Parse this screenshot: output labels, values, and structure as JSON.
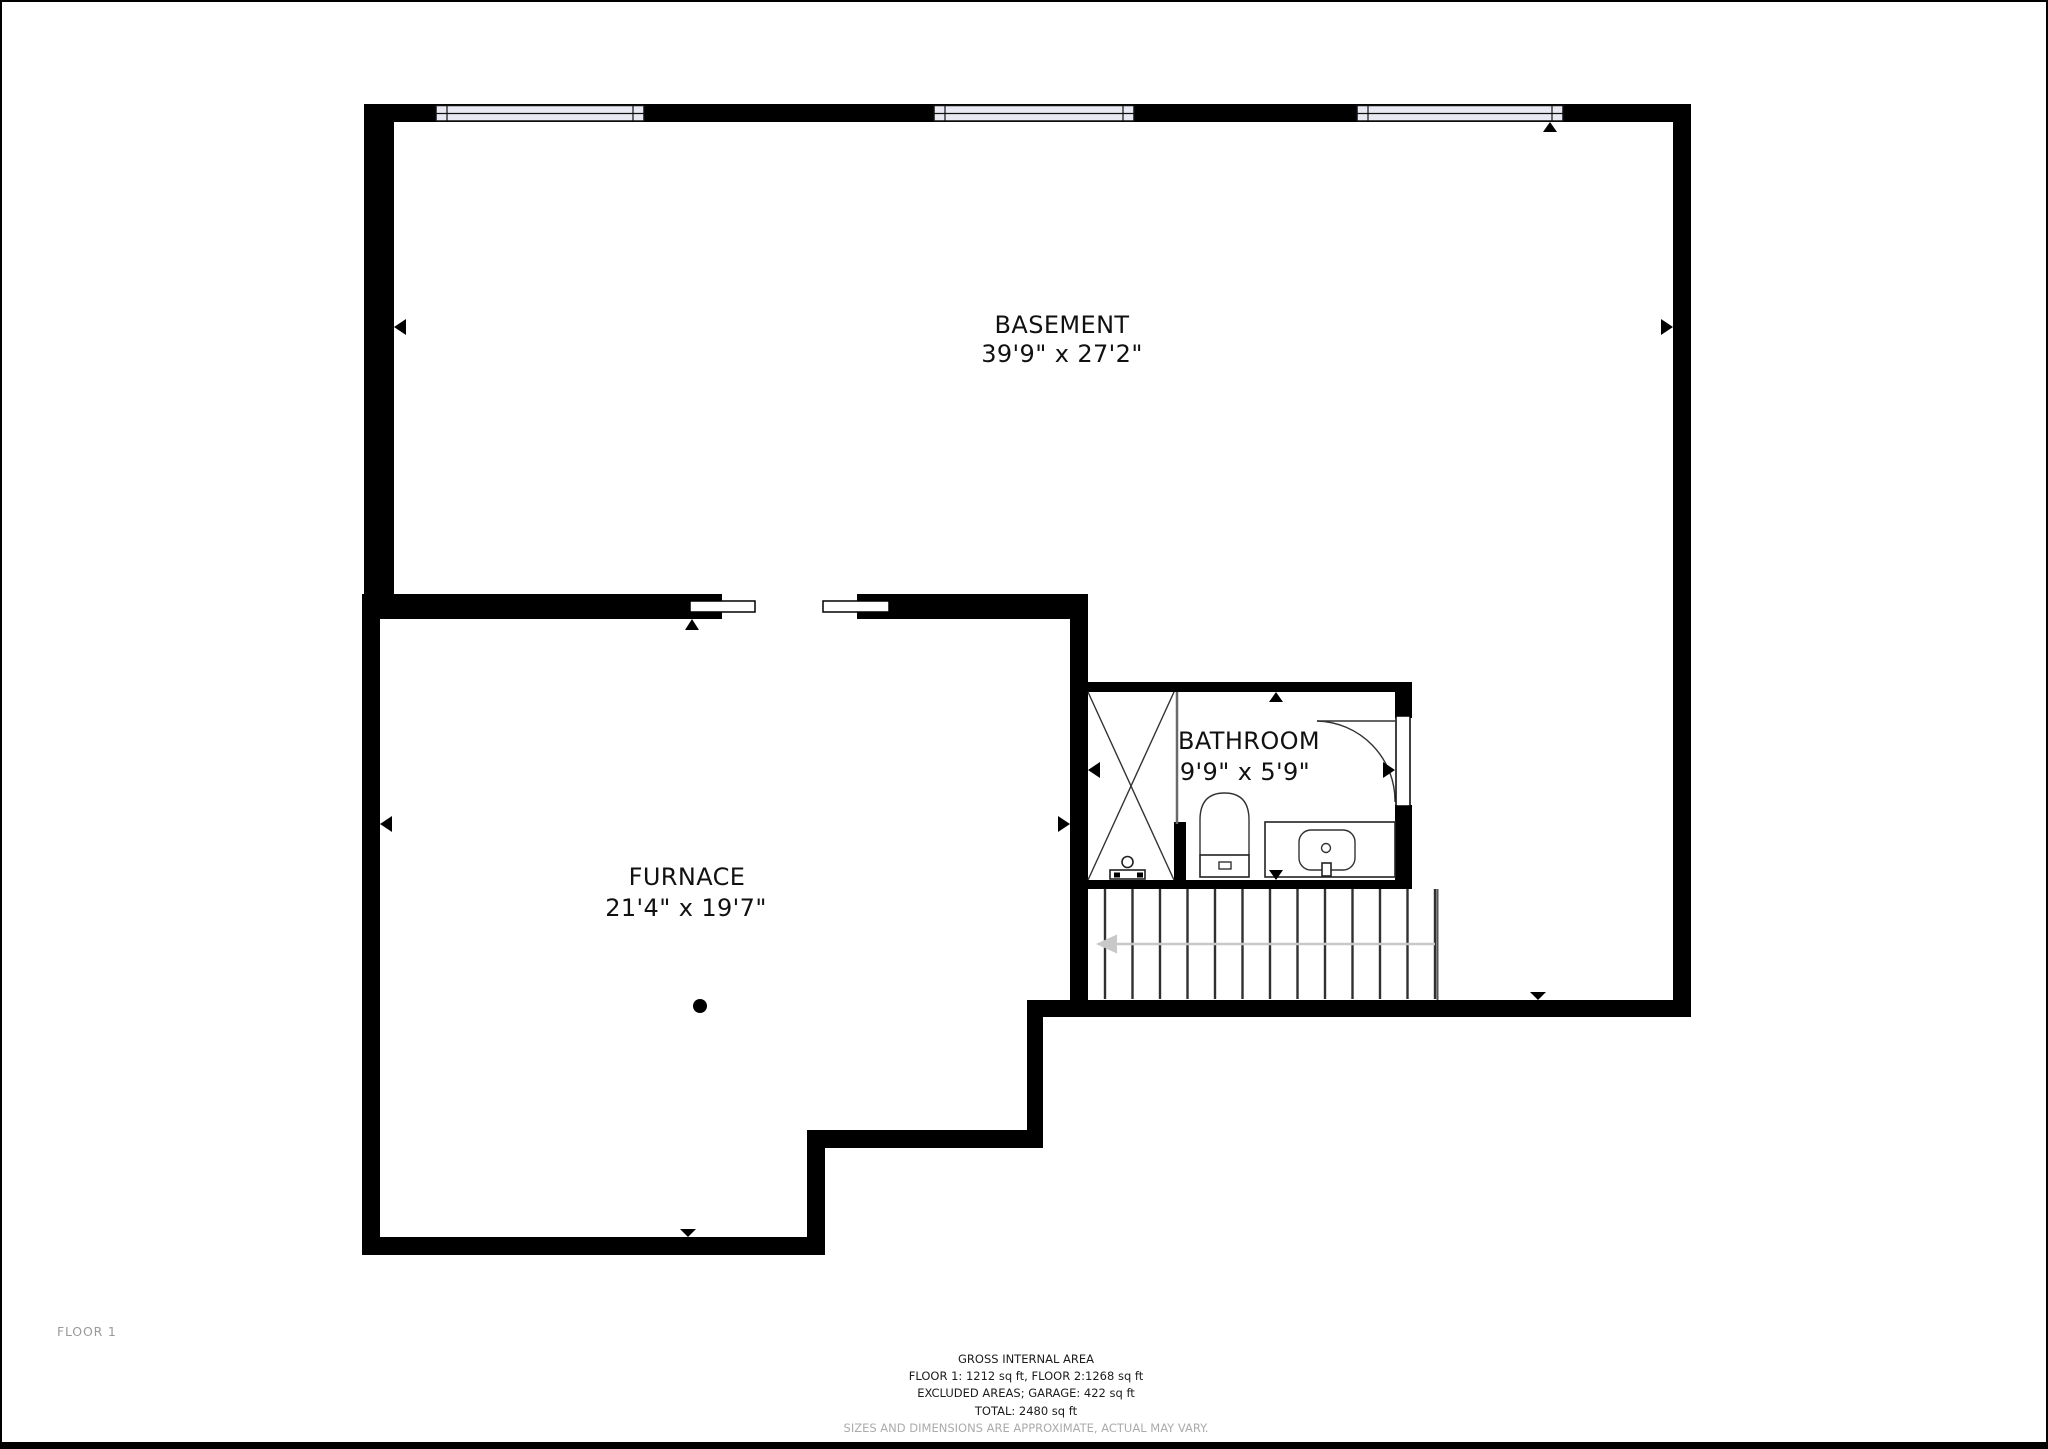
{
  "floor_label": "FLOOR 1",
  "rooms": [
    {
      "name": "BASEMENT",
      "dimensions": "39'9\" x 27'2\""
    },
    {
      "name": "FURNACE",
      "dimensions": "21'4\" x 19'7\""
    },
    {
      "name": "BATHROOM",
      "dimensions": "9'9\" x 5'9\""
    }
  ],
  "summary": {
    "title": "GROSS INTERNAL AREA",
    "floors": "FLOOR 1: 1212 sq ft, FLOOR 2:1268 sq ft",
    "excluded": "EXCLUDED AREAS; GARAGE: 422 sq ft",
    "total": "TOTAL: 2480 sq ft",
    "disclaimer": "SIZES AND DIMENSIONS ARE APPROXIMATE, ACTUAL MAY VARY."
  },
  "icons": {
    "wall_marker": "small black triangle pointing at wall",
    "stair_arrow": "gray arrow pointing left (stair direction)",
    "shower": "crossed-box shower enclosure",
    "toilet": "toilet with tank",
    "sink": "vanity with oval basin",
    "door_arc": "door swing arc",
    "floor_drain": "black dot floor drain"
  },
  "colors": {
    "wall": "#000000",
    "window_fill": "#e9e9f3",
    "stair_line": "#303030",
    "gray_arrow": "#c8c8c8",
    "muted_text": "#9a9a9a",
    "disclaimer_text": "#ababab"
  }
}
